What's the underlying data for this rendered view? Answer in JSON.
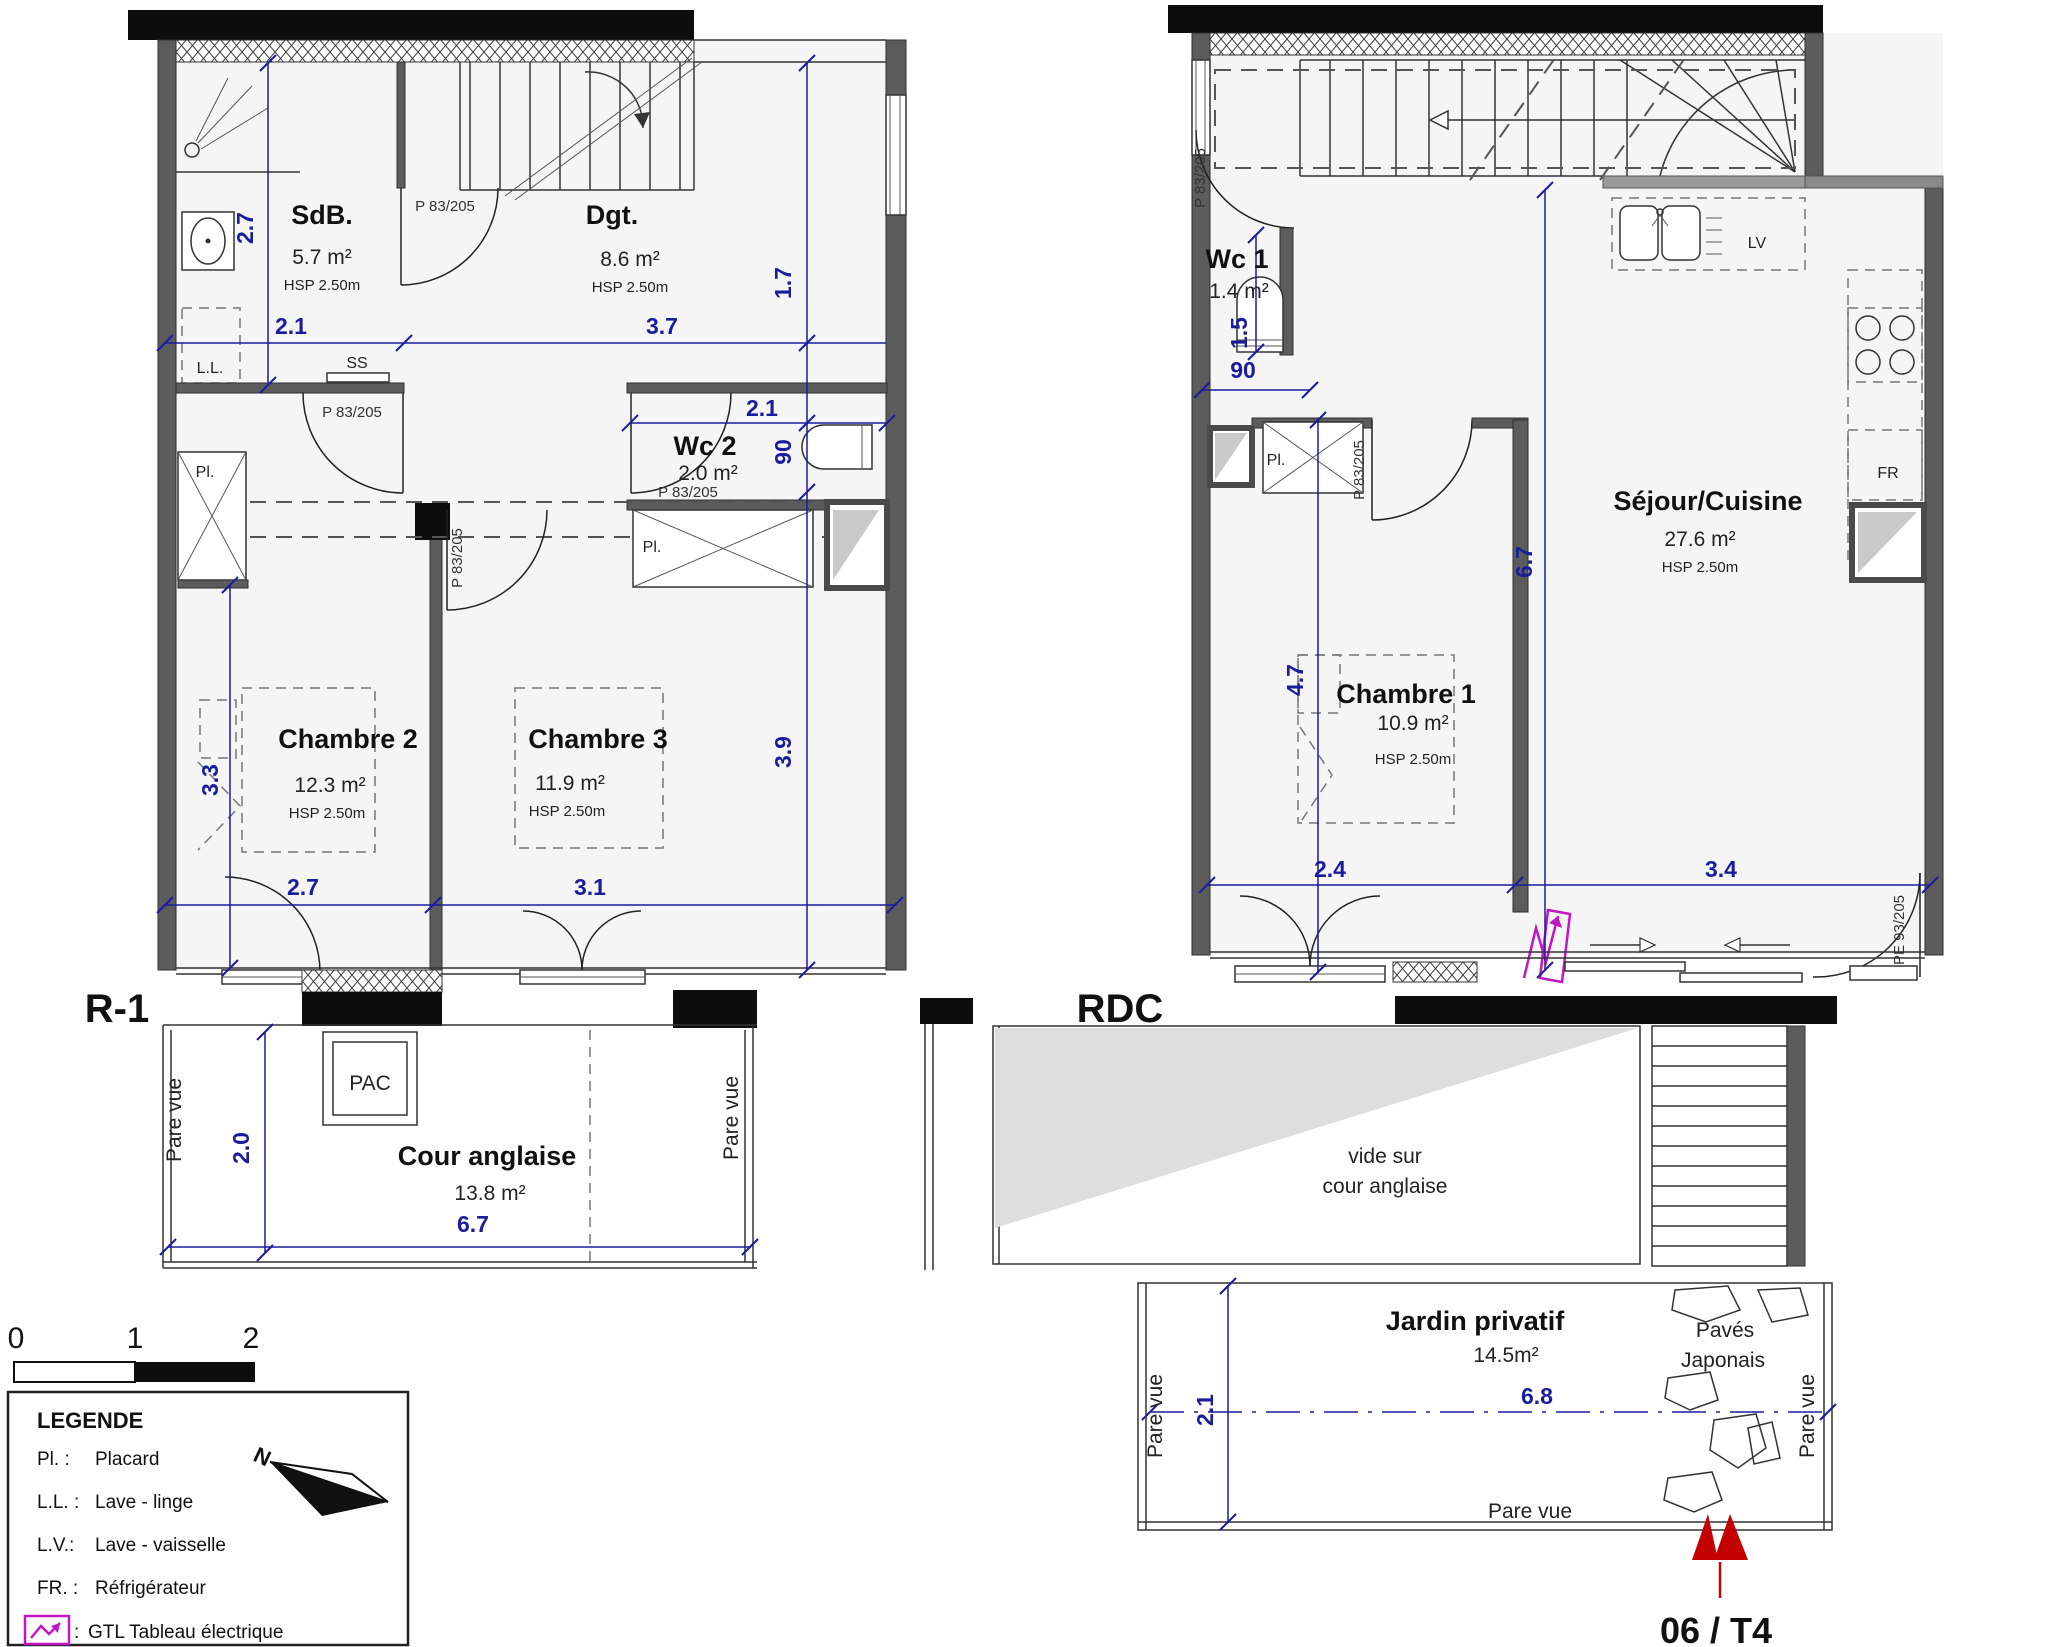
{
  "colors": {
    "dim_blue": "#1b1b9e",
    "wall_gray": "#5c5c5c",
    "magenta": "#c316c3",
    "logo_red": "#c40000",
    "vide_gray": "#dedede"
  },
  "scale_bar": {
    "n0": "0",
    "n1": "1",
    "n2": "2"
  },
  "legend": {
    "title": "LEGENDE",
    "north": "N",
    "items": [
      {
        "abbr": "Pl. :",
        "label": "Placard"
      },
      {
        "abbr": "L.L. :",
        "label": "Lave - linge"
      },
      {
        "abbr": "L.V.:",
        "label": "Lave - vaisselle"
      },
      {
        "abbr": "FR. :",
        "label": "Réfrigérateur"
      },
      {
        "abbr": ":",
        "label": "GTL Tableau électrique"
      }
    ]
  },
  "unit": "06 / T4",
  "r1": {
    "label": "R-1",
    "pare_vue_left": "Pare vue",
    "pare_vue_right": "Pare vue",
    "sdb_name": "SdB.",
    "sdb_area": "5.7 m²",
    "sdb_hsp": "HSP 2.50m",
    "dgt_name": "Dgt.",
    "dgt_area": "8.6 m²",
    "dgt_hsp": "HSP 2.50m",
    "wc2_name": "Wc 2",
    "wc2_area": "2.0 m²",
    "c2_name": "Chambre 2",
    "c2_area": "12.3 m²",
    "c2_hsp": "HSP 2.50m",
    "c3_name": "Chambre 3",
    "c3_area": "11.9 m²",
    "c3_hsp": "HSP 2.50m",
    "cour_name": "Cour anglaise",
    "cour_area": "13.8 m²",
    "pac": "PAC",
    "ll": "L.L.",
    "ss": "SS",
    "pl_c2": "Pl.",
    "pl_wc2": "Pl.",
    "door_sdb": "P 83/205",
    "door_hall": "P 83/205",
    "door_wc2": "P 83/205",
    "door_c3": "P 83/205",
    "dims": {
      "sdb_h": "2.7",
      "sdb_w": "2.1",
      "dgt_w": "3.7",
      "right_top": "1.7",
      "wc2_w": "2.1",
      "wc2_h": "90",
      "c2_h": "3.3",
      "c3_h": "3.9",
      "c2_w": "2.7",
      "c3_w": "3.1",
      "cour_h": "2.0",
      "cour_w": "6.7"
    }
  },
  "rdc": {
    "label": "RDC",
    "wc1_name": "Wc 1",
    "wc1_area": "1.4 m²",
    "sejour_name": "Séjour/Cuisine",
    "sejour_area": "27.6 m²",
    "sejour_hsp": "HSP 2.50m",
    "c1_name": "Chambre 1",
    "c1_area": "10.9 m²",
    "c1_hsp": "HSP 2.50m",
    "pl": "Pl.",
    "lv": "LV",
    "fr": "FR",
    "door_wc1": "P 83/205",
    "door_c1": "P 83/205",
    "door_entry": "PE 93/205",
    "vide_l1": "vide sur",
    "vide_l2": "cour anglaise",
    "jardin_name": "Jardin privatif",
    "jardin_area": "14.5m²",
    "paves_l1": "Pavés",
    "paves_l2": "Japonais",
    "pare_vue_left": "Pare vue",
    "pare_vue_bottom": "Pare vue",
    "pare_vue_right": "Pare vue",
    "dims": {
      "wc1_h": "1.5",
      "wc1_w": "90",
      "c1_h": "4.7",
      "sejour_h": "6.7",
      "c1_w": "2.4",
      "entry_w": "3.4",
      "jardin_h": "2.1",
      "jardin_w": "6.8"
    }
  }
}
